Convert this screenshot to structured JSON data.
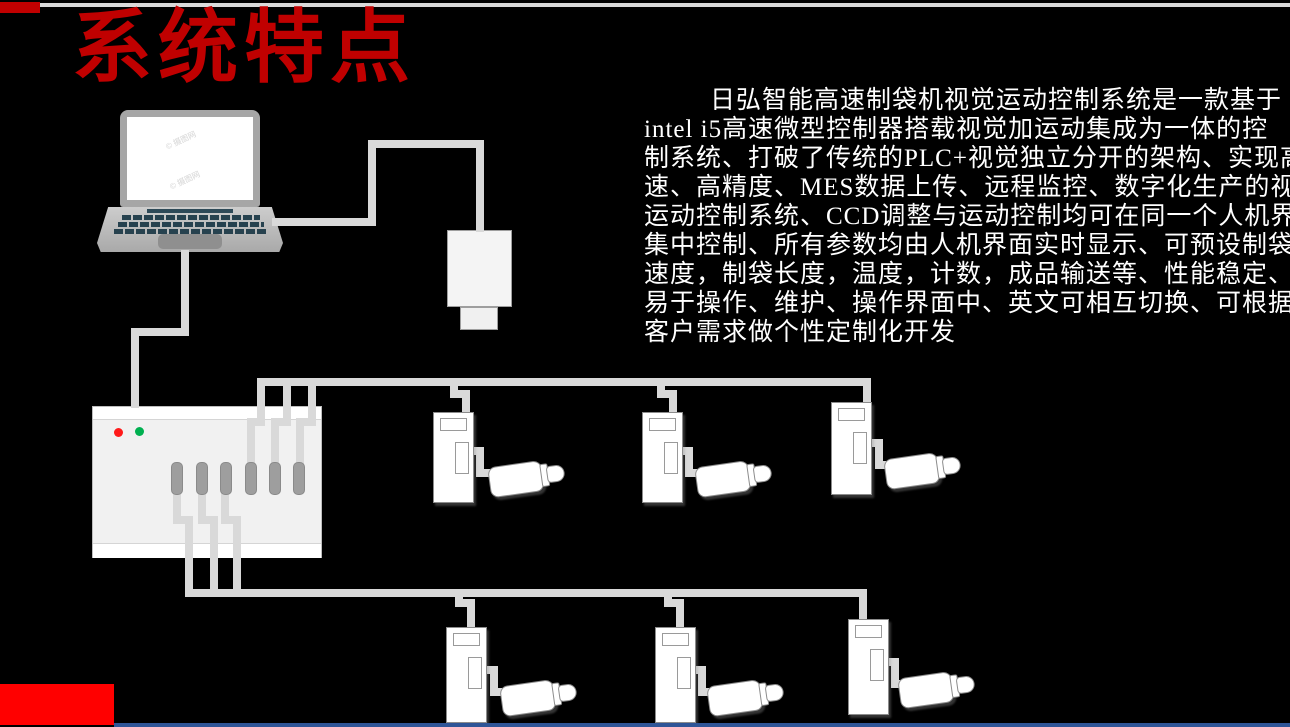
{
  "slide": {
    "title": "系统特点",
    "watermark": "© 摄图网",
    "body": {
      "lines": [
        "日弘智能高速制袋机视觉运动控制系统是一款基于",
        "intel i5高速微型控制器搭载视觉加运动集成为一体的控",
        "制系统、打破了传统的PLC+视觉独立分开的架构、实现高",
        "速、高精度、MES数据上传、远程监控、数字化生产的视觉",
        "运动控制系统、CCD调整与运动控制均可在同一个人机界面",
        "集中控制、所有参数均由人机界面实时显示、可预设制袋",
        "速度，制袋长度，温度，计数，成品输送等、性能稳定、",
        "易于操作、维护、操作界面中、英文可相互切换、可根据",
        "客户需求做个性定制化开发"
      ],
      "full_text": "日弘智能高速制袋机视觉运动控制系统是一款基于intel i5高速微型控制器搭载视觉加运动集成为一体的控制系统、打破了传统的PLC+视觉独立分开的架构、实现高速、高精度、MES数据上传、远程监控、数字化生产的视觉运动控制系统、CCD调整与运动控制均可在同一个人机界面集中控制、所有参数均由人机界面实时显示、可预设制袋速度，制袋长度，温度，计数，成品输送等、性能稳定、易于操作、维护、操作界面中、英文可相互切换、可根据客户需求做个性定制化开发"
    },
    "colors": {
      "background": "#000000",
      "title_red": "#C00000",
      "corner_red": "#C00000",
      "footer_red": "#FF0000",
      "footer_blue": "#2F5597",
      "top_line_gray": "#D9D9D9",
      "cable_gray": "#D9D9D9",
      "device_border_gray": "#8C8C8C",
      "led_red": "#FF1A1A",
      "led_green": "#00B050",
      "keyboard_teal": "#27424F"
    },
    "diagram": {
      "laptop": "laptop-computer",
      "camera": "industrial-camera",
      "controller": "motion-controller",
      "controller_terminals": 6,
      "controller_leds": [
        "red",
        "green"
      ],
      "servo_units_top_row": 3,
      "servo_units_bottom_row": 3
    }
  }
}
